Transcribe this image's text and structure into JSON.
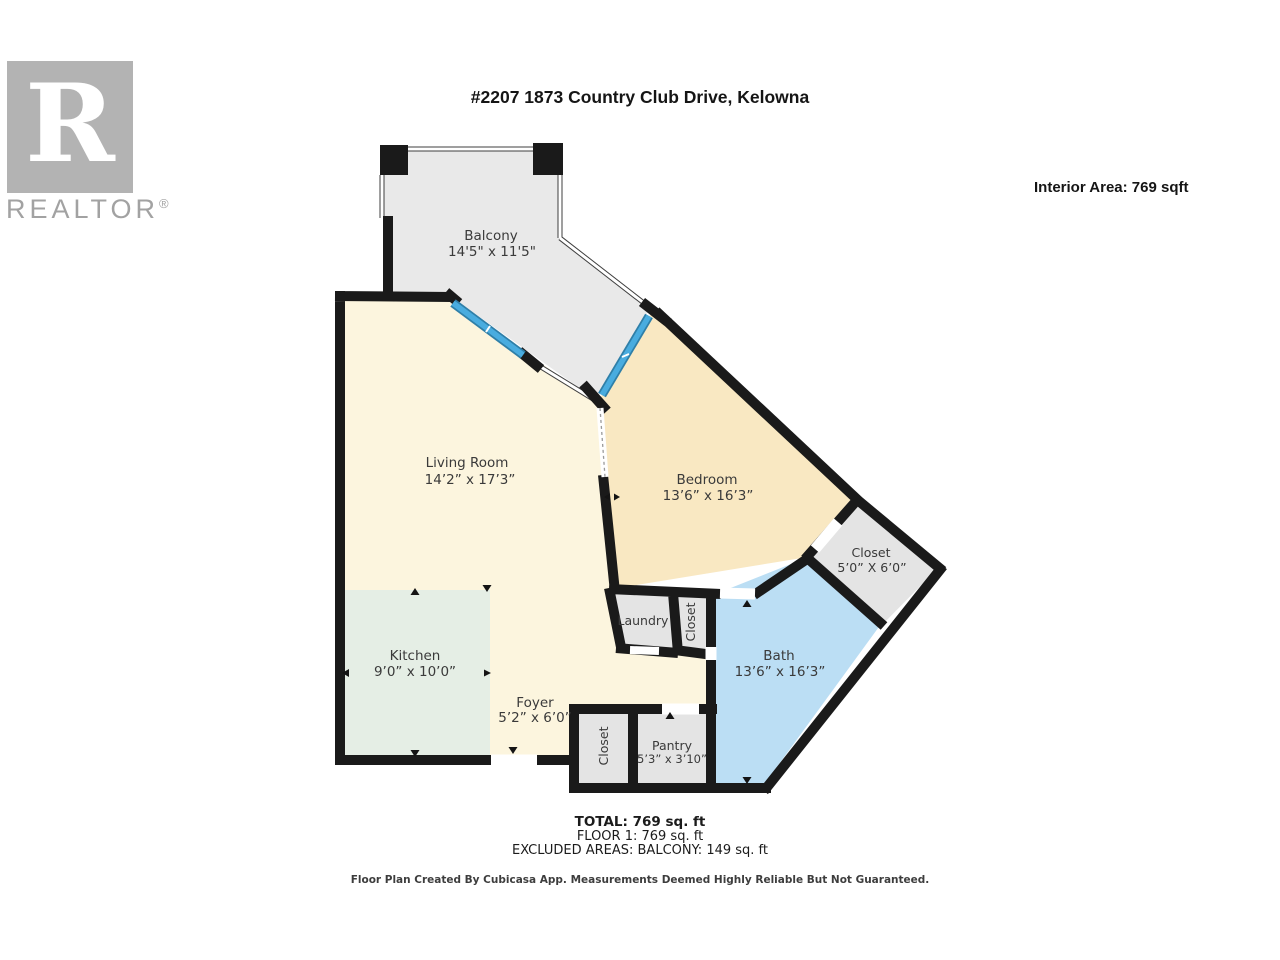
{
  "logo": {
    "letter": "R",
    "brand": "REALTOR",
    "registered": "®"
  },
  "header": {
    "title": "#2207 1873 Country Club Drive, Kelowna",
    "interior_area": "Interior Area: 769 sqft"
  },
  "rooms": {
    "balcony": {
      "name": "Balcony",
      "dims": "14'5\" x 11'5\""
    },
    "living_room": {
      "name": "Living Room",
      "dims": "14’2” x 17’3”"
    },
    "bedroom": {
      "name": "Bedroom",
      "dims": "13’6” x 16’3”"
    },
    "closet": {
      "name": "Closet",
      "dims": "5’0” X 6’0”"
    },
    "bath": {
      "name": "Bath",
      "dims": "13’6” x 16’3”"
    },
    "laundry": {
      "name": "Laundry"
    },
    "closet_mid": {
      "name": "Closet"
    },
    "kitchen": {
      "name": "Kitchen",
      "dims": "9’0” x 10’0”"
    },
    "foyer": {
      "name": "Foyer",
      "dims": "5’2” x 6’0”"
    },
    "closet_bottom": {
      "name": "Closet"
    },
    "pantry": {
      "name": "Pantry",
      "dims": "5’3” x 3’10”"
    }
  },
  "summary": {
    "total": "TOTAL: 769 sq. ft",
    "floor1": "FLOOR 1: 769 sq. ft",
    "excluded": "EXCLUDED AREAS: BALCONY: 149 sq. ft"
  },
  "footer": {
    "disclaimer": "Floor Plan Created By Cubicasa App. Measurements Deemed Highly Reliable But Not Guaranteed."
  },
  "colors": {
    "wall": "#1a1a1a",
    "balcony": "#e9e9e9",
    "living": "#fcf5de",
    "bedroom": "#f9e8c2",
    "bath": "#bbdef4",
    "kitchen": "#e5eee5",
    "utility": "#e4e4e4",
    "door": "#49acdf",
    "logo_gray": "#b3b3b3",
    "label_text": "#3a3a3a"
  }
}
